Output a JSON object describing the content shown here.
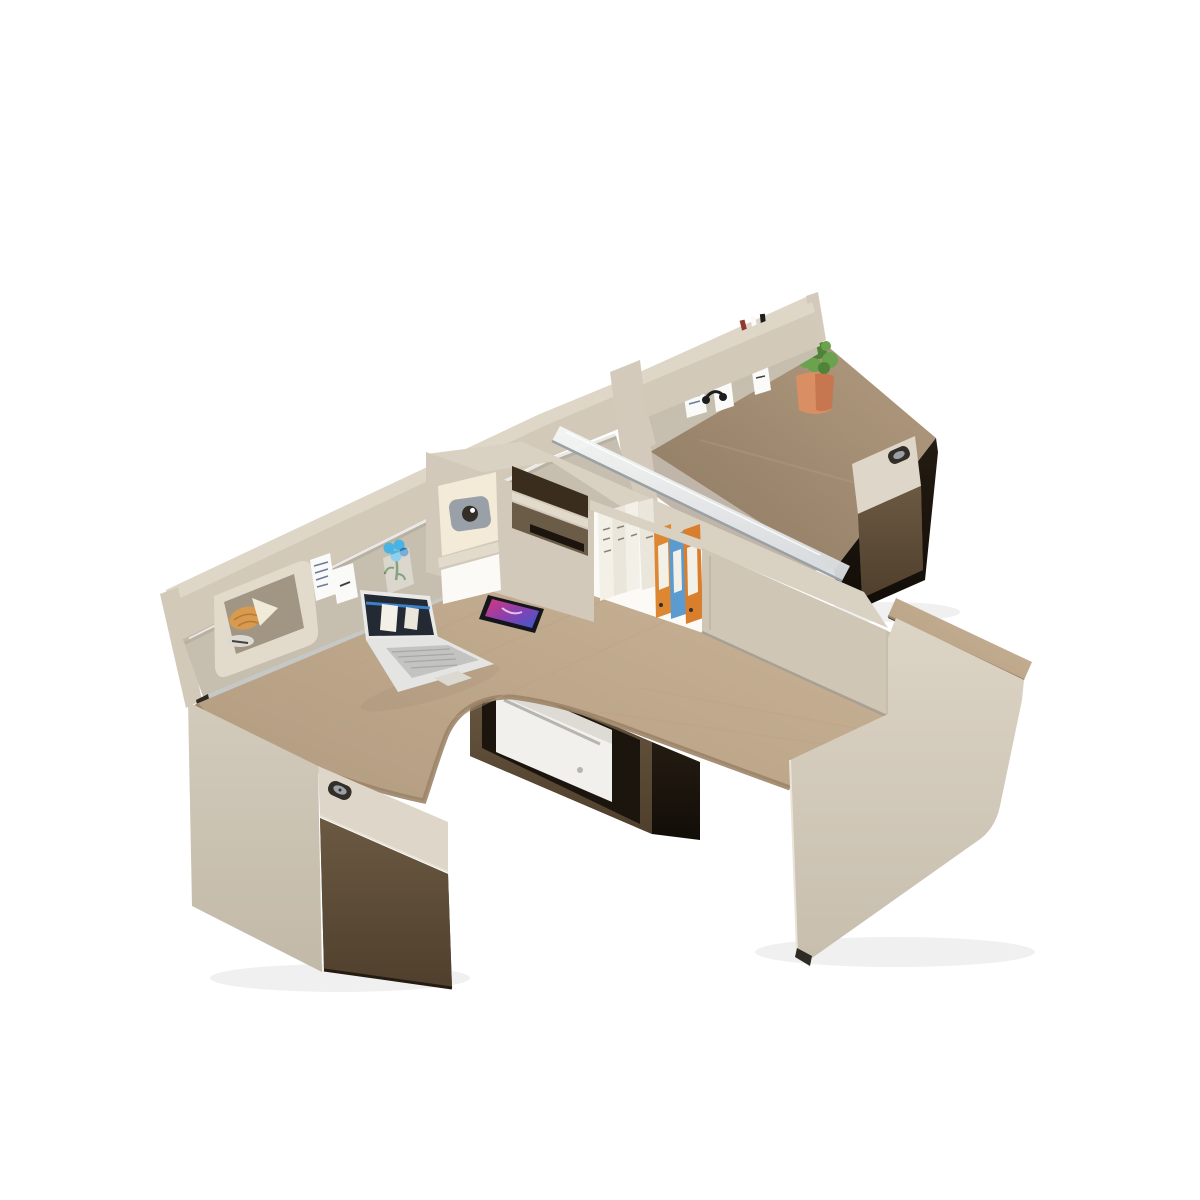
{
  "figure": {
    "alt": "Product photo: two-person staggered L-shaped office workstation with champagne-beige panels, light oak desktops, perforated pegboard privacy screens, glass divider, shelving with books and binders, walnut storage cabinets, laptop, smartphone, printer and succulent plant, on a white background",
    "background": "#ffffff"
  },
  "palette": {
    "bg": "#ffffff",
    "rail_top": "#ded6c7",
    "rail_front": "#d2c9b9",
    "post": "#d3cabb",
    "pegboard": "#c6beaf",
    "pegboard_shadow": "rgba(90,80,60,0.25)",
    "peg_hole": "#ffffff",
    "glass_light": "#f5f7f7",
    "glass_dark": "#d8dcdf",
    "glass_edge": "#9aa0a3",
    "counter": "#d9d1c2",
    "corner_face": "#d2c9ba",
    "opening_warm": "#f3ead8",
    "opening_bright": "#fbfaf6",
    "opening_dark": "#3a2d1e",
    "opening_mid": "#6b5c48",
    "shelf_lip": "#e2dbcc",
    "book_white": "#f3f0e8",
    "book_white2": "#eae6db",
    "book_text": "#8a8578",
    "binder_orange": "#dd8733",
    "binder_orange2": "#d97e2c",
    "binder_blue": "#5b9bd0",
    "door": "#cfc6b6",
    "door_edge": "#a7a094",
    "wood_left_1": "#ccb698",
    "wood_left_2": "#b29b80",
    "wood_far_1": "#b39c80",
    "wood_far_2": "#8d7962",
    "wood_edge": "#9c8468",
    "wood_streak": "#bca287",
    "walnut_1": "#6b5942",
    "walnut_2": "#4f3f2c",
    "dark_recess": "#1c150e",
    "shadow_brown": "#241c12",
    "shadow_brown2": "#120d08",
    "printer_body": "#f1f0ed",
    "printer_shade": "#dddbd4",
    "printer_slot": "#b7b5b0",
    "pedestal_face": "#d2cabb",
    "pedestal_face2": "#c2b9a8",
    "drawer_face": "#ded7c9",
    "lock_body": "#332e28",
    "lock_metal": "#9aa0a8",
    "panel_right_1": "#dcd4c5",
    "panel_right_2": "#c7beae",
    "panel_edge_light": "#eae4d8",
    "plant_green": "#6aa24e",
    "plant_green_dark": "#4e8338",
    "pot_orange": "#d98f63",
    "pot_orange_dark": "#c2714a",
    "basket_red": "#b6503f",
    "basket_red_dark": "#8e3a30",
    "note_white": "#fafaf8",
    "note_line": "#6b7b9c",
    "note_dark": "#44403a",
    "headphone_black": "#1d1d1f",
    "laptop_silver": "#e9e9e7",
    "laptop_deck": "#e4e4e2",
    "key_gray": "#c3c3c1",
    "key_line": "#9b9b99",
    "screen_dark": "#232a34",
    "screen_blue": "#3f8ad8",
    "phone_body": "#14161c",
    "phone_p1": "#d5397b",
    "phone_p2": "#8b3fae",
    "phone_p3": "#3b5bd0",
    "croissant": "#d89a4e",
    "croissant_dark": "#b67a33",
    "cheese_white": "#f2ead8",
    "plate": "#dcd9d2",
    "flower_blue": "#49b4e4",
    "flower_core": "#2a7ab8",
    "stem_green": "#3a6b35",
    "pocket_white": "rgba(255,255,255,0.38)",
    "metal_strip": "#c6c8c6",
    "foot_dark": "#2e2a24",
    "grain_dark": "rgba(50,38,22,0.28)",
    "grain_light": "rgba(255,240,220,0.10)",
    "soft_shadow": "rgba(0,0,0,0.06)",
    "seam_dark": "#3a3228"
  },
  "scene": {
    "items": [
      {
        "id": "workstation",
        "label": "Two-person staggered office workstation"
      },
      {
        "id": "far-desktop",
        "label": "Far desk light oak desktop"
      },
      {
        "id": "far-pedestal",
        "label": "Far pedestal with locking drawer and walnut front"
      },
      {
        "id": "succulent-plant",
        "label": "Succulent in terracotta pot"
      },
      {
        "id": "far-pegboard",
        "label": "Far perforated pegboard privacy screen"
      },
      {
        "id": "pen-caddy",
        "label": "Red hanging pen caddy with pens"
      },
      {
        "id": "far-notes",
        "label": "Sticky notes and earphones hung on far pegboard"
      },
      {
        "id": "spine-rail",
        "label": "Champagne beige divider rail"
      },
      {
        "id": "left-pegboard",
        "label": "Left perforated pegboard privacy screen"
      },
      {
        "id": "accessory-tray",
        "label": "Pegboard accessory tray with croissant and saucer"
      },
      {
        "id": "left-notes",
        "label": "Sticky notes on left pegboard"
      },
      {
        "id": "flower-clip",
        "label": "Blue flower clipped to pegboard pocket"
      },
      {
        "id": "glass-divider",
        "label": "Low glass divider on storage counter"
      },
      {
        "id": "printer-cubby",
        "label": "Under-desk walnut cubby with white printer"
      },
      {
        "id": "left-desktop",
        "label": "Left L-shaped light oak desktop with curved seat cutout"
      },
      {
        "id": "laptop",
        "label": "Open silver laptop with dark screen"
      },
      {
        "id": "smartphone",
        "label": "Smartphone with colorful screen lying on desk"
      },
      {
        "id": "corner-shelf",
        "label": "Corner cubby shelf with camera and tablet"
      },
      {
        "id": "book-shelf",
        "label": "Open shelf with white books, two orange binders and one blue binder"
      },
      {
        "id": "sliding-door",
        "label": "Sliding-door storage hutch"
      },
      {
        "id": "right-desktop-end",
        "label": "Right desk oak desktop end"
      },
      {
        "id": "right-leg-panel",
        "label": "Beige leg panel with rounded corner"
      },
      {
        "id": "left-pedestal",
        "label": "Left pedestal cabinet with lock drawer and walnut door"
      }
    ]
  }
}
